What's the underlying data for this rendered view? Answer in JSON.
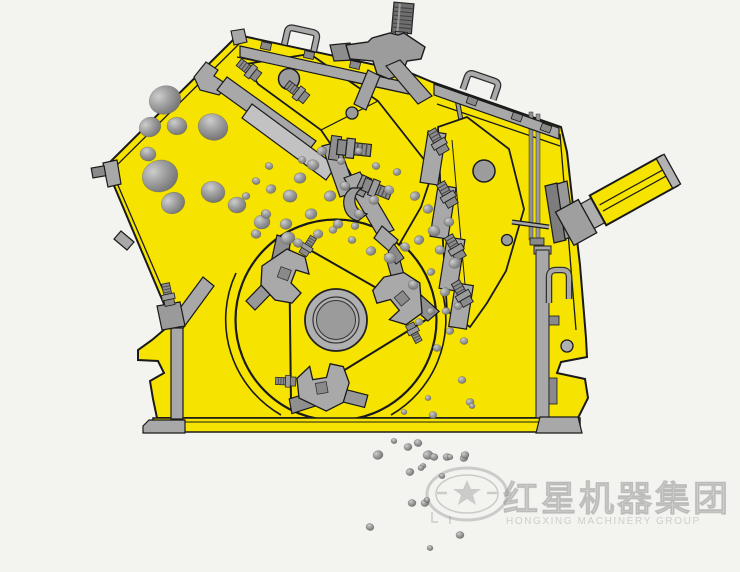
{
  "image": {
    "type": "technical-illustration",
    "subject": "impact crusher cross-section diagram"
  },
  "watermark": {
    "brand_cn": "红星机器集团",
    "brand_en": "HONGXING MACHINERY GROUP"
  },
  "colors": {
    "background": "#f3f3f0",
    "machine_yellow": "#f6e400",
    "outline": "#1a1a1a",
    "metal": "#a8a8a8",
    "metal_dark": "#8a8a8a",
    "metal_light": "#c2c2c2"
  },
  "rocks": {
    "chute": [
      [
        165,
        100,
        16
      ],
      [
        150,
        127,
        11
      ],
      [
        177,
        126,
        10
      ],
      [
        213,
        127,
        15
      ],
      [
        160,
        176,
        18
      ],
      [
        173,
        203,
        12
      ],
      [
        213,
        192,
        12
      ],
      [
        148,
        154,
        8
      ],
      [
        237,
        205,
        9
      ],
      [
        262,
        222,
        8
      ],
      [
        288,
        238,
        7
      ]
    ],
    "chamber": [
      [
        300,
        178,
        6
      ],
      [
        313,
        165,
        6
      ],
      [
        290,
        196,
        7
      ],
      [
        271,
        189,
        5
      ],
      [
        330,
        196,
        6
      ],
      [
        345,
        186,
        5
      ],
      [
        311,
        214,
        6
      ],
      [
        286,
        224,
        6
      ],
      [
        266,
        214,
        5
      ],
      [
        256,
        234,
        5
      ],
      [
        298,
        243,
        5
      ],
      [
        318,
        234,
        5
      ],
      [
        338,
        224,
        5
      ],
      [
        359,
        214,
        5
      ],
      [
        374,
        200,
        5
      ],
      [
        389,
        190,
        5
      ],
      [
        352,
        240,
        4
      ],
      [
        371,
        251,
        5
      ],
      [
        390,
        258,
        6
      ],
      [
        405,
        247,
        5
      ],
      [
        419,
        240,
        5
      ],
      [
        434,
        231,
        6
      ],
      [
        449,
        222,
        5
      ],
      [
        428,
        209,
        5
      ],
      [
        415,
        196,
        5
      ],
      [
        440,
        250,
        5
      ],
      [
        455,
        263,
        6
      ],
      [
        431,
        272,
        4
      ],
      [
        413,
        285,
        5
      ],
      [
        445,
        292,
        5
      ],
      [
        458,
        306,
        4
      ],
      [
        431,
        311,
        4
      ],
      [
        419,
        322,
        4
      ],
      [
        450,
        331,
        4
      ],
      [
        437,
        348,
        4
      ],
      [
        464,
        341,
        4
      ],
      [
        302,
        160,
        4
      ],
      [
        322,
        151,
        5
      ],
      [
        341,
        161,
        4
      ],
      [
        359,
        151,
        4
      ],
      [
        376,
        166,
        4
      ],
      [
        397,
        172,
        4
      ],
      [
        269,
        166,
        4
      ],
      [
        256,
        181,
        4
      ],
      [
        246,
        196,
        4
      ],
      [
        355,
        226,
        4
      ],
      [
        333,
        230,
        4
      ],
      [
        446,
        311,
        4
      ],
      [
        462,
        380,
        4
      ],
      [
        470,
        402,
        4
      ],
      [
        433,
        415,
        4
      ],
      [
        428,
        398,
        3
      ],
      [
        404,
        412,
        3
      ]
    ],
    "discharge": [
      [
        428,
        455,
        5
      ],
      [
        447,
        457,
        4
      ],
      [
        464,
        458,
        4
      ],
      [
        423,
        466,
        3
      ],
      [
        378,
        455,
        5
      ],
      [
        408,
        447,
        4
      ],
      [
        418,
        443,
        4
      ],
      [
        434,
        457,
        4
      ],
      [
        450,
        457,
        3
      ],
      [
        465,
        455,
        4
      ],
      [
        410,
        472,
        4
      ],
      [
        421,
        468,
        3
      ],
      [
        412,
        503,
        4
      ],
      [
        425,
        503,
        4
      ],
      [
        370,
        527,
        4
      ],
      [
        427,
        500,
        3
      ],
      [
        460,
        535,
        4
      ],
      [
        430,
        548,
        3
      ],
      [
        394,
        441,
        3
      ],
      [
        442,
        476,
        3
      ],
      [
        472,
        406,
        3
      ]
    ]
  }
}
